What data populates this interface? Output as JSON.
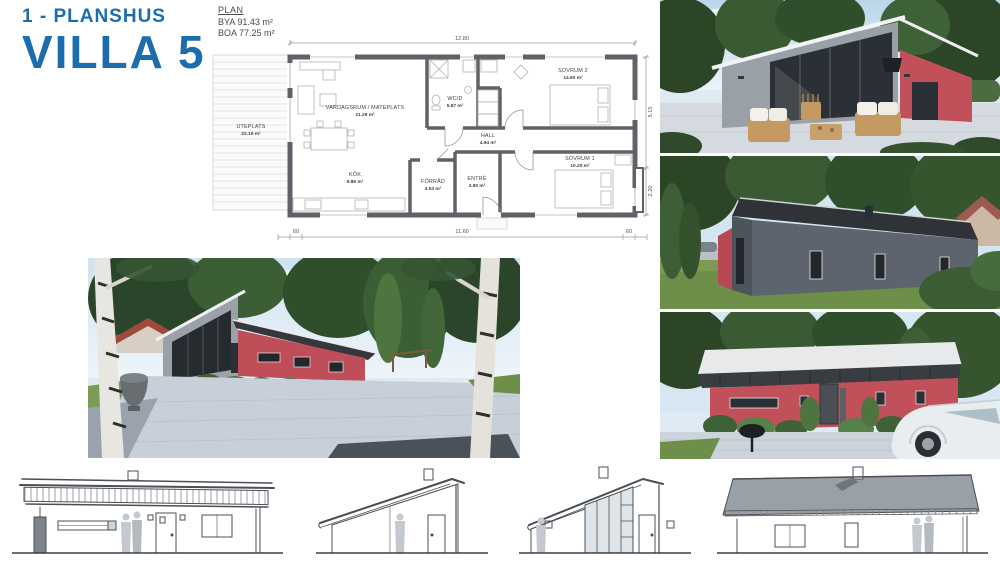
{
  "header": {
    "project_type": "1 - PLANSHUS",
    "title": "VILLA 5"
  },
  "plan": {
    "label": "PLAN",
    "bya": "BYA 91.43 m²",
    "boa": "BOA 77.25 m²",
    "rooms": [
      {
        "name": "UTEPLATS",
        "area": "22.19 m²"
      },
      {
        "name": "VARDAGSRUM / MATEPLATS",
        "area": "21.29 m²"
      },
      {
        "name": "KÖK",
        "area": "9.86 m²"
      },
      {
        "name": "WC/D",
        "area": "5.87 m²"
      },
      {
        "name": "HALL",
        "area": "4.94 m²"
      },
      {
        "name": "FÖRRÅD",
        "area": "3.53 m²"
      },
      {
        "name": "ENTRÉ",
        "area": "3.90 m²"
      },
      {
        "name": "SOVRUM 1",
        "area": "10.20 m²"
      },
      {
        "name": "SOVRUM 2",
        "area": "14.80 m²"
      }
    ],
    "dimensions": {
      "overall_width": "12.80",
      "right_upper": "5.15",
      "right_lower": "2.20",
      "eave_left": "60",
      "interior_width": "11.60",
      "eave_right": "60"
    }
  },
  "colors": {
    "accent_blue": "#1c6dad",
    "facade_red": "#c2505a",
    "facade_gray": "#9aa0a8",
    "roof_dark": "#34383d",
    "plan_wall": "#5f6368"
  }
}
